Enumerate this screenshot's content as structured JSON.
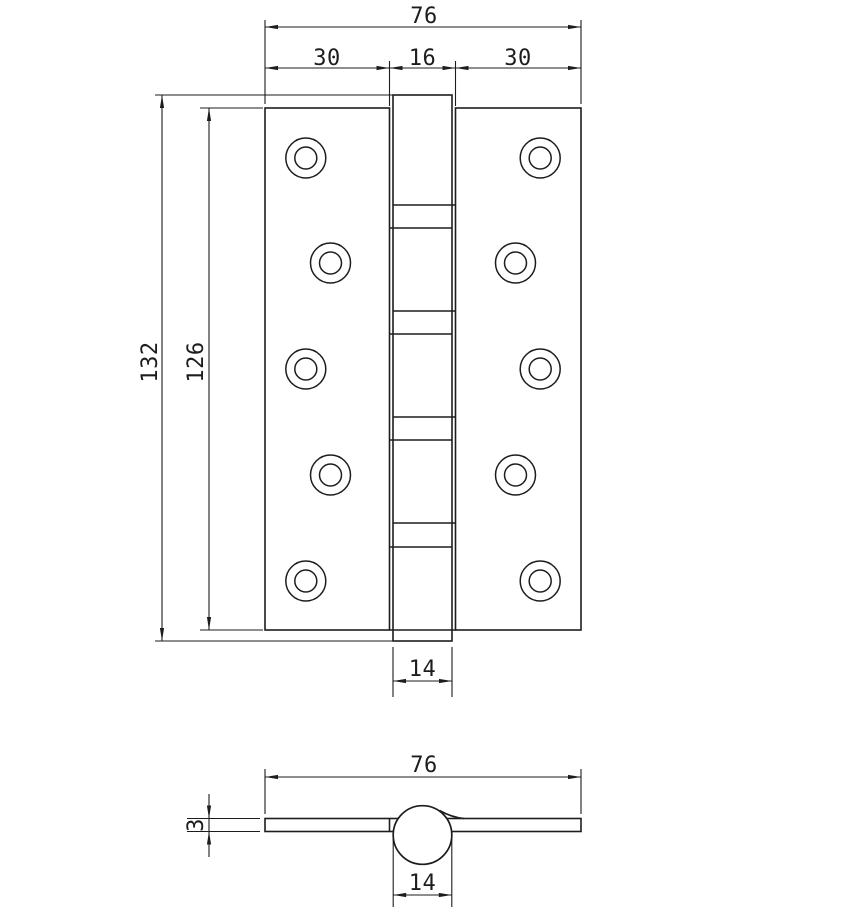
{
  "drawing_title": "hinge-technical-drawing",
  "front_view": {
    "width_total": "76",
    "leaf_left_width": "30",
    "pin_gap_width": "16",
    "leaf_right_width": "30",
    "height_total": "132",
    "leaf_height": "126",
    "knuckle_width": "14"
  },
  "section_view": {
    "width_total": "76",
    "leaf_thickness": "3",
    "barrel_diameter": "14"
  },
  "colors": {
    "line": "#1d1d1d",
    "background": "#ffffff"
  }
}
